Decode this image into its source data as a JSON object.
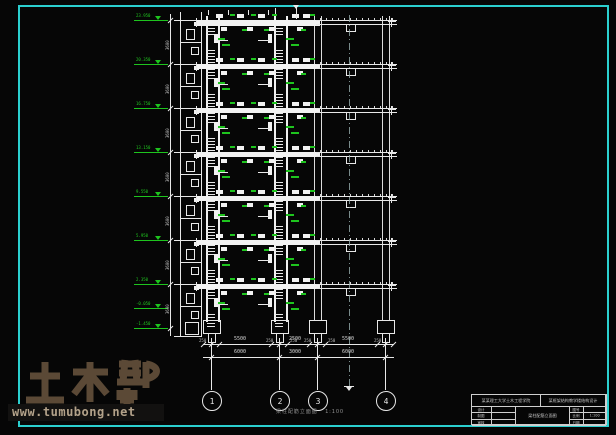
{
  "colors": {
    "sheet_border": "#2bcfcf",
    "drawing_line": "#e8e8e8",
    "annotation_green": "#1ec41e",
    "watermark_brown": "#5b4936",
    "watermark_url_tan": "#b3a28a",
    "caption_gray": "#8f8f8f"
  },
  "watermark": {
    "title": "土木帮",
    "url": "www.tumubong.net"
  },
  "caption": {
    "title": "梁柱配筋立面图",
    "scale": "1:100"
  },
  "levels": {
    "labels": [
      "23.950",
      "20.350",
      "16.750",
      "13.150",
      "9.550",
      "5.950",
      "2.350",
      "-0.050",
      "-1.450"
    ]
  },
  "story_dimension": "3600",
  "grid": {
    "bubbles": [
      "1",
      "2",
      "3",
      "4"
    ]
  },
  "dimensions": {
    "row1": [
      "5500",
      "2500",
      "5500"
    ],
    "row1_sub": "250",
    "row2": [
      "6000",
      "3000",
      "6000"
    ]
  },
  "title_block": {
    "org": "某某理工大学土木工程学院",
    "project": "某框架结构教学楼结构设计",
    "left_rows": [
      {
        "label": "设计",
        "value": ""
      },
      {
        "label": "制图",
        "value": ""
      },
      {
        "label": "审核",
        "value": ""
      }
    ],
    "drawing_title": "梁柱配筋立面图",
    "right_rows": [
      {
        "label": "图号",
        "value": ""
      },
      {
        "label": "比例",
        "value": "1:100"
      },
      {
        "label": "日期",
        "value": ""
      }
    ]
  }
}
